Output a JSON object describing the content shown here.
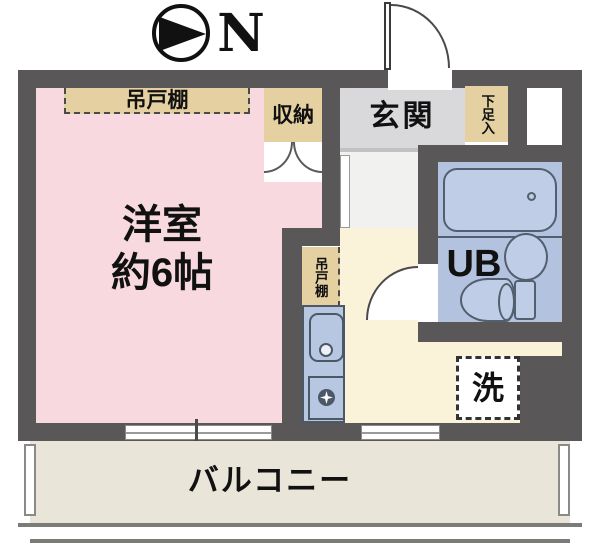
{
  "compass": {
    "north_label": "N"
  },
  "plan": {
    "main_room": {
      "name": "洋室",
      "size": "約6帖"
    },
    "entrance": {
      "label": "玄関"
    },
    "unit_bath": {
      "label": "UB"
    },
    "balcony": {
      "label": "バルコニー"
    },
    "storage": {
      "label": "収納"
    },
    "shoe_cabinet": {
      "label": "下足入"
    },
    "hanging_cupboard_main": {
      "label": "吊戸棚"
    },
    "hanging_cupboard_kitchen": {
      "label": "吊戸棚"
    },
    "washing_machine": {
      "label": "洗"
    }
  },
  "colors": {
    "wall": "#595757",
    "main_room_floor": "#f7d9df",
    "cabinet": "#e5d0a2",
    "entrance_floor": "#d9d9db",
    "hall_floor": "#f1f1ef",
    "kitchen_floor": "#faf3d9",
    "unit_bath_floor": "#b3c3df",
    "fixture_outline": "#535f6e",
    "balcony_floor": "#e9e5d8"
  }
}
